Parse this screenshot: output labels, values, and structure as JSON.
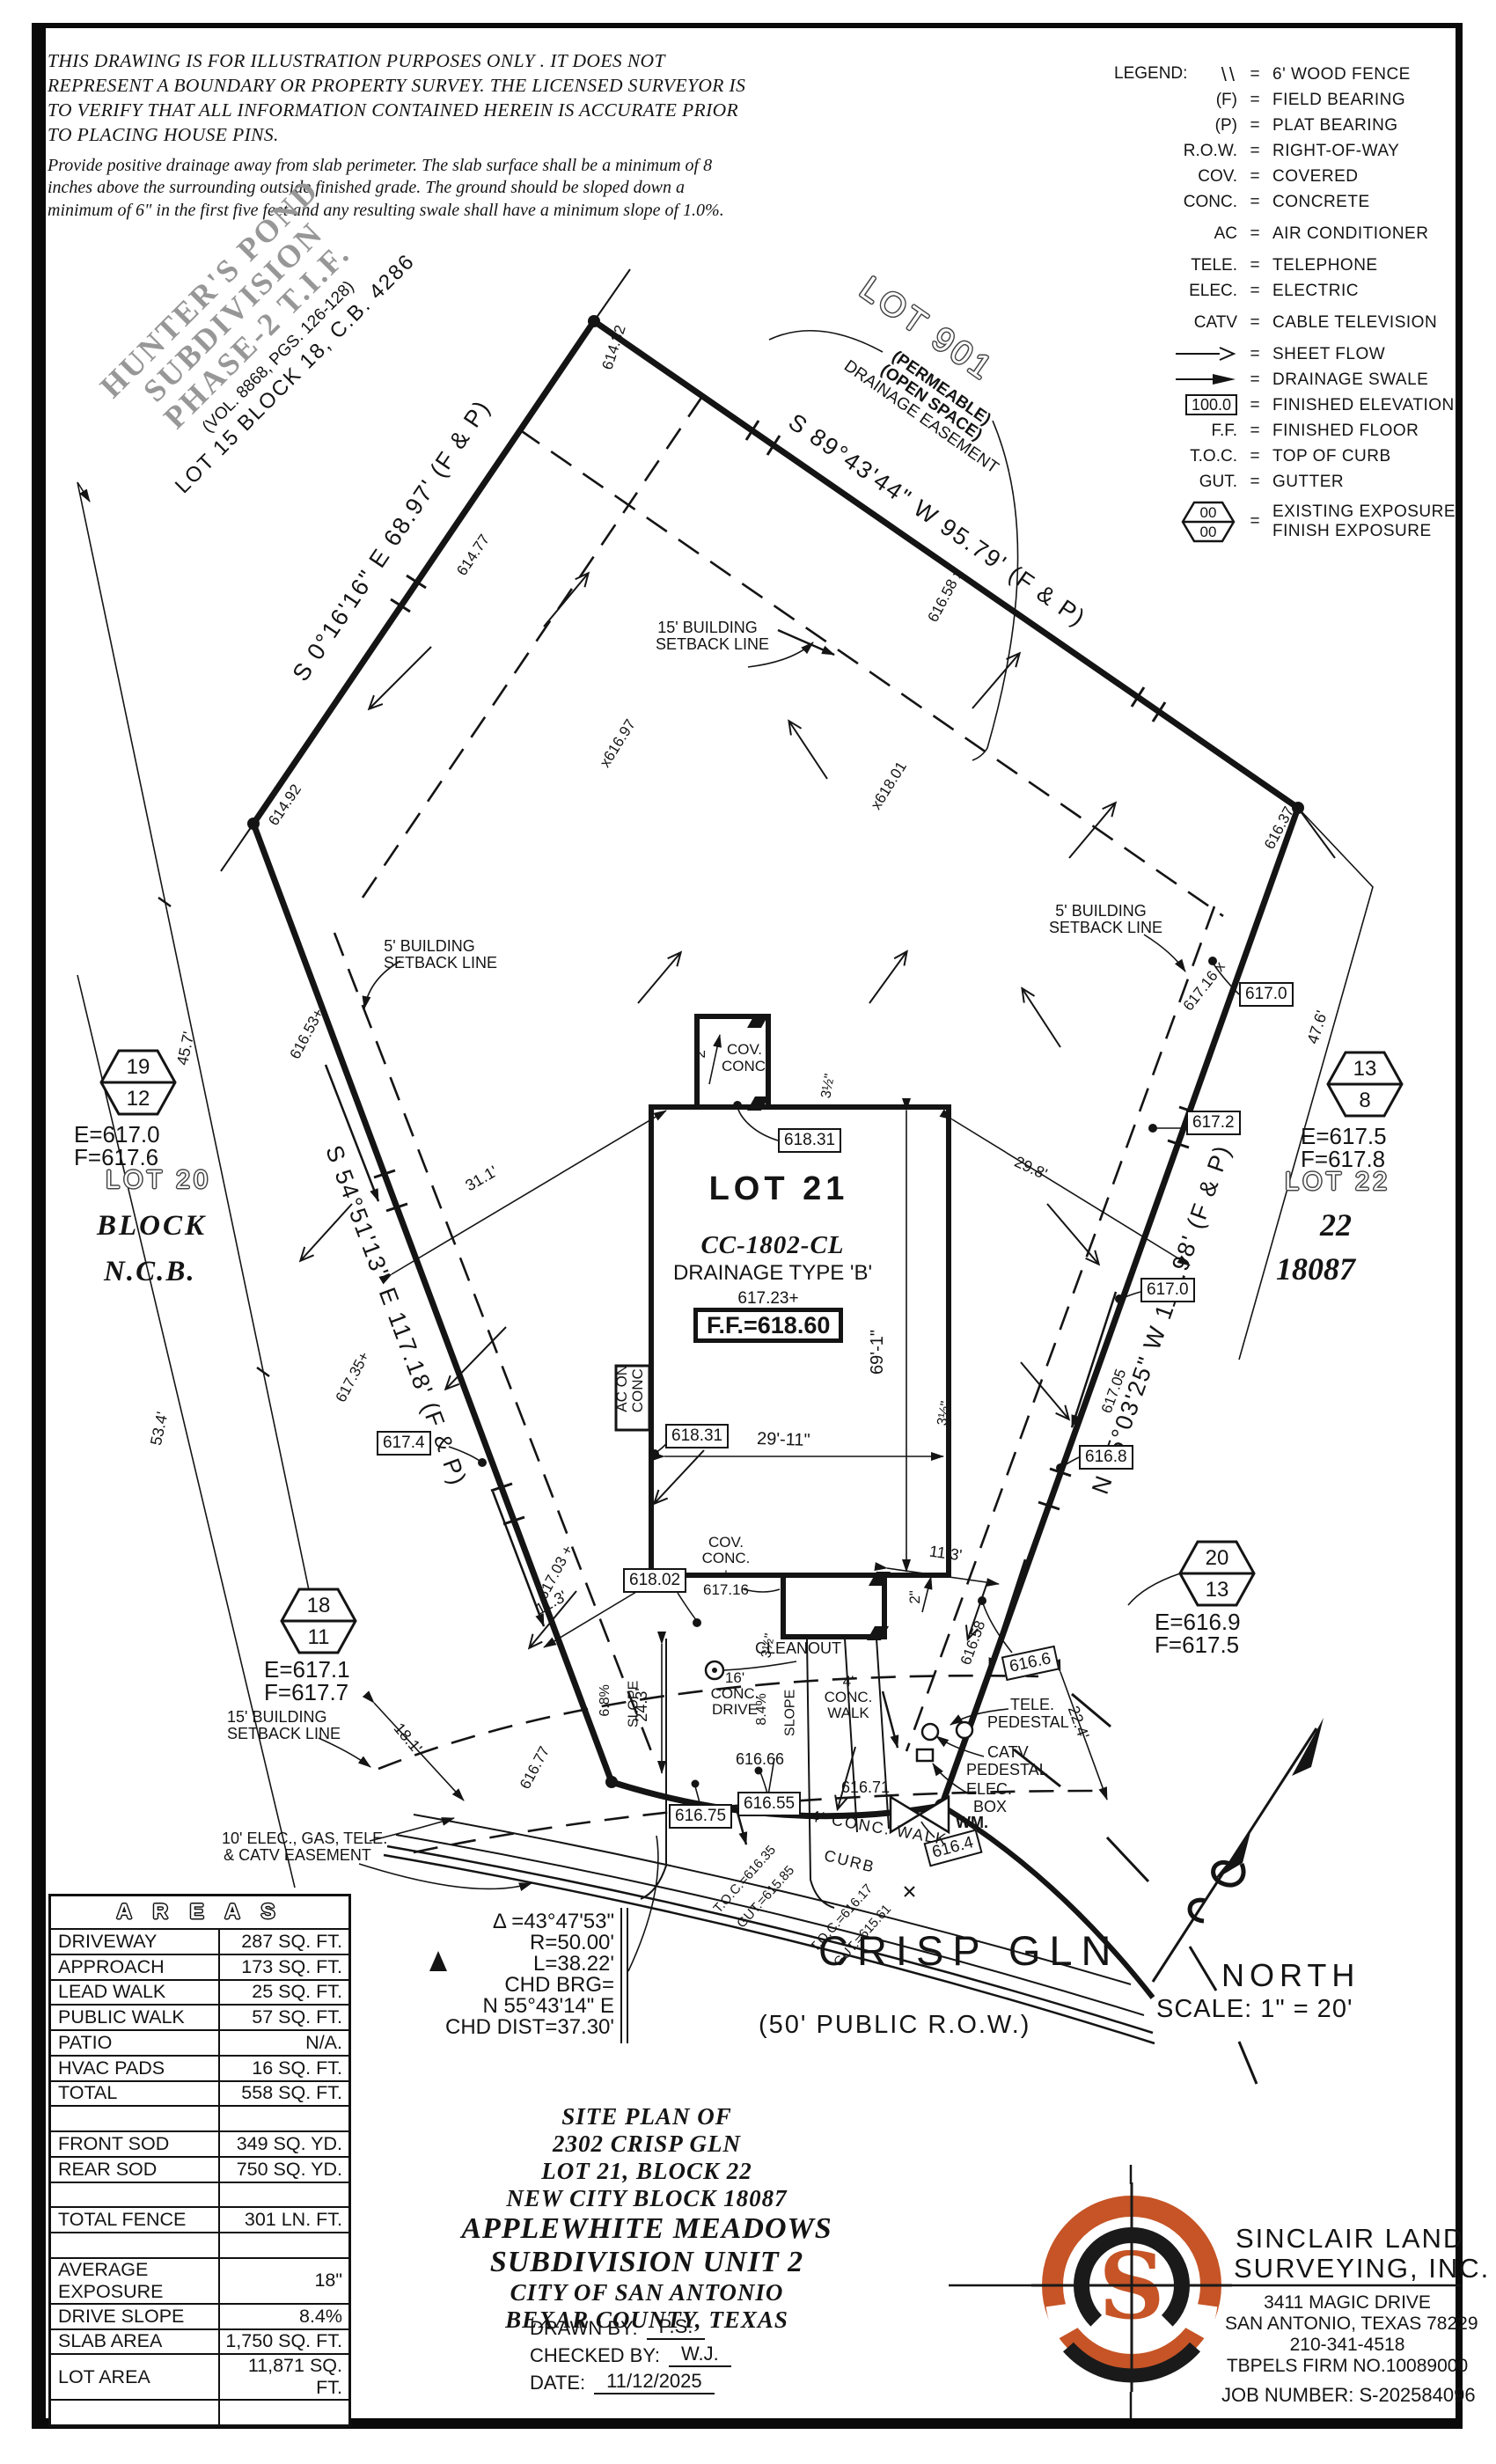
{
  "disclaimer": {
    "para1": "THIS DRAWING IS FOR ILLUSTRATION PURPOSES ONLY . IT DOES NOT REPRESENT A BOUNDARY OR PROPERTY SURVEY. THE LICENSED SURVEYOR IS TO VERIFY THAT ALL INFORMATION CONTAINED HEREIN IS ACCURATE PRIOR TO PLACING HOUSE PINS.",
    "para2": "Provide positive drainage away from slab perimeter. The slab surface shall be a minimum of 8 inches above the surrounding outside finished grade. The ground should be sloped down a minimum of 6\" in the first five feet and any resulting swale shall have a minimum slope of 1.0%."
  },
  "legend": {
    "title": "LEGEND:",
    "eq": "=",
    "hex_top": "00",
    "hex_bot": "00",
    "fin_elev_value": "100.0",
    "items": [
      {
        "sym": "\\\\",
        "label": "6' WOOD FENCE"
      },
      {
        "sym": "(F)",
        "label": "FIELD BEARING"
      },
      {
        "sym": "(P)",
        "label": "PLAT BEARING"
      },
      {
        "sym": "R.O.W.",
        "label": "RIGHT-OF-WAY"
      },
      {
        "sym": "COV.",
        "label": "COVERED"
      },
      {
        "sym": "CONC.",
        "label": "CONCRETE"
      },
      {
        "sym": "AC",
        "label": "AIR CONDITIONER"
      },
      {
        "sym": "TELE.",
        "label": "TELEPHONE"
      },
      {
        "sym": "ELEC.",
        "label": "ELECTRIC"
      },
      {
        "sym": "CATV",
        "label": "CABLE TELEVISION"
      },
      {
        "sym": "",
        "label": "SHEET FLOW"
      },
      {
        "sym": "",
        "label": "DRAINAGE SWALE"
      },
      {
        "sym": "",
        "label": "FINISHED ELEVATION"
      },
      {
        "sym": "F.F.",
        "label": "FINISHED FLOOR"
      },
      {
        "sym": "T.O.C.",
        "label": "TOP OF CURB"
      },
      {
        "sym": "GUT.",
        "label": "GUTTER"
      },
      {
        "sym": "",
        "label": "EXISTING EXPOSURE",
        "label2": "FINISH EXPOSURE"
      }
    ]
  },
  "neighbor": {
    "name1": "HUNTER'S POND",
    "name2": "SUBDIVISION",
    "name3": "PHASE-2  T.I.F.",
    "vol": "(VOL. 8868, PGS. 126-128)",
    "lot15": "LOT 15 BLOCK 18, C.B. 4286"
  },
  "lot901": {
    "label": "LOT 901",
    "l1": "(PERMEABLE)",
    "l2": "(OPEN SPACE)",
    "l3": "DRAINAGE EASEMENT"
  },
  "bearings": {
    "nw": "S 0°16'16\" E  68.97'  (F & P)",
    "ne": "S 89°43'44\" W  95.79'  (F & P)",
    "west": "S 54°51'13\" E  117.18'  (F & P)",
    "east": "N 15°03'25\" W  119.98'  (F & P)"
  },
  "adjacent": {
    "lot20": "LOT 20",
    "block": "BLOCK",
    "ncb": "N.C.B.",
    "lot22": "LOT 22",
    "plat22": "22",
    "plat18087": "18087"
  },
  "exposures": {
    "nw": {
      "top": "19",
      "bot": "12",
      "e": "E=617.0",
      "f": "F=617.6"
    },
    "sw": {
      "top": "18",
      "bot": "11",
      "e": "E=617.1",
      "f": "F=617.7"
    },
    "ne": {
      "top": "13",
      "bot": "8",
      "e": "E=617.5",
      "f": "F=617.8"
    },
    "se": {
      "top": "20",
      "bot": "13",
      "e": "E=616.9",
      "f": "F=617.5"
    }
  },
  "house": {
    "lot": "LOT 21",
    "plan": "CC-1802-CL",
    "drainage": "DRAINAGE TYPE 'B'",
    "pad": "617.23+",
    "ff": "F.F.=618.60"
  },
  "setback": {
    "b15": "15' BUILDING",
    "b5": "5' BUILDING",
    "line": "SETBACK LINE"
  },
  "easement10": {
    "l1": "10' ELEC., GAS, TELE.",
    "l2": "& CATV EASEMENT"
  },
  "features": {
    "cov": "COV.",
    "conc": "CONC.",
    "plus": "+",
    "v617_16": "617.16",
    "ac1": "AC ON",
    "ac2": "CONC.",
    "cleanout": "CLEANOUT",
    "drive1": "16'",
    "drive2": "CONC.",
    "drive3": "DRIVE",
    "walk1": "4'",
    "walk2": "CONC.",
    "walk3": "WALK",
    "walk_inline": "4' CONC. WALK",
    "curb": "CURB",
    "slope68": "6.8%",
    "slope84": "8.4%",
    "slope_word": "SLOPE",
    "tele1": "TELE.",
    "tele2": "PEDESTAL",
    "catv1": "CATV",
    "catv2": "PEDESTAL",
    "elec1": "ELEC.",
    "elec2": "BOX",
    "wm": "WM."
  },
  "spot": {
    "v614_32": "614.32",
    "v614_77": "614.77",
    "v614_92": "614.92",
    "v616_37": "616.37",
    "v616_58x": "616.58 x",
    "vx616_97": "x616.97",
    "vx618_01": "x618.01",
    "v616_53": "616.53+",
    "v617_35": "617.35+",
    "v617_03": "617.03 +",
    "v617_16x": "617.16 x",
    "v617_05": "617.05",
    "v616_58": "616.58",
    "v616_77": "616.77",
    "v616_66": "616.66",
    "v616_71": "616.71"
  },
  "ebox": {
    "v618_31": "618.31",
    "v618_02": "618.02",
    "v617_4": "617.4",
    "v617_0": "617.0",
    "v617_2": "617.2",
    "v616_8": "616.8",
    "v616_6": "616.6",
    "v616_75": "616.75",
    "v616_55": "616.55",
    "v616_4": "616.4"
  },
  "dim": {
    "d45_7": "45.7'",
    "d53_4": "53.4'",
    "d47_6": "47.6'",
    "d31_1": "31.1'",
    "d29_8": "29.8'",
    "d29_11": "29'-11\"",
    "d69_1": "69'-1\"",
    "d24_3": "24.3'",
    "d18_1": "18.1'",
    "d11_3": "11.3'",
    "d22_4": "22.4'",
    "d2in": "2\"",
    "d3h": "3½\""
  },
  "toc": {
    "t1": "T.O.C.=616.35",
    "g1": "GUT.=615.85",
    "t2": "T.O.C.=616.17",
    "g2": "GUT.=615.61"
  },
  "street": {
    "name": "CRISP GLN",
    "row": "(50' PUBLIC R.O.W.)"
  },
  "curve": {
    "l1": "Δ =43°47'53\"",
    "l2": "R=50.00'",
    "l3": "L=38.22'",
    "l4": "CHD BRG=",
    "l5": "N 55°43'14\" E",
    "l6": "CHD DIST=37.30'"
  },
  "north": {
    "label": "NORTH",
    "scale": "SCALE:  1\" = 20'"
  },
  "title": {
    "l1": "SITE PLAN OF",
    "l2": "2302 CRISP GLN",
    "l3": "LOT 21, BLOCK 22",
    "l4": "NEW CITY BLOCK 18087",
    "l5": "APPLEWHITE MEADOWS",
    "l6": "SUBDIVISION UNIT 2",
    "l7": "CITY OF SAN ANTONIO",
    "l8": "BEXAR COUNTY, TEXAS",
    "drawn_label": "DRAWN BY:",
    "drawn": "P.S.",
    "checked_label": "CHECKED BY:",
    "checked": "W.J.",
    "date_label": "DATE:",
    "date": "11/12/2025"
  },
  "firm": {
    "logo_s": "S",
    "name1": "SINCLAIR LAND",
    "name2": "SURVEYING, INC.",
    "addr1": "3411 MAGIC DRIVE",
    "addr2": "SAN ANTONIO, TEXAS 78229",
    "phone": "210-341-4518",
    "tbpels": "TBPELS FIRM NO.10089000",
    "job": "JOB NUMBER:  S-202584096"
  },
  "areas_table": {
    "header": "A R E A S",
    "rows": [
      [
        "DRIVEWAY",
        "287 SQ. FT."
      ],
      [
        "APPROACH",
        "173 SQ. FT."
      ],
      [
        "LEAD WALK",
        "25 SQ. FT."
      ],
      [
        "PUBLIC WALK",
        "57 SQ. FT."
      ],
      [
        "PATIO",
        "N/A."
      ],
      [
        "HVAC PADS",
        "16 SQ. FT."
      ],
      [
        "TOTAL",
        "558 SQ. FT."
      ],
      [
        "",
        ""
      ],
      [
        "FRONT SOD",
        "349 SQ. YD."
      ],
      [
        "REAR SOD",
        "750 SQ. YD."
      ],
      [
        "",
        ""
      ],
      [
        "TOTAL FENCE",
        "301 LN. FT."
      ],
      [
        "",
        ""
      ],
      [
        "AVERAGE EXPOSURE",
        "18\""
      ],
      [
        "DRIVE SLOPE",
        "8.4%"
      ],
      [
        "SLAB AREA",
        "1,750 SQ. FT."
      ],
      [
        "LOT AREA",
        "11,871 SQ. FT."
      ],
      [
        "",
        ""
      ]
    ]
  },
  "colors": {
    "accent_orange": "#C65426",
    "ink": "#141414",
    "gray_text": "#979797"
  }
}
